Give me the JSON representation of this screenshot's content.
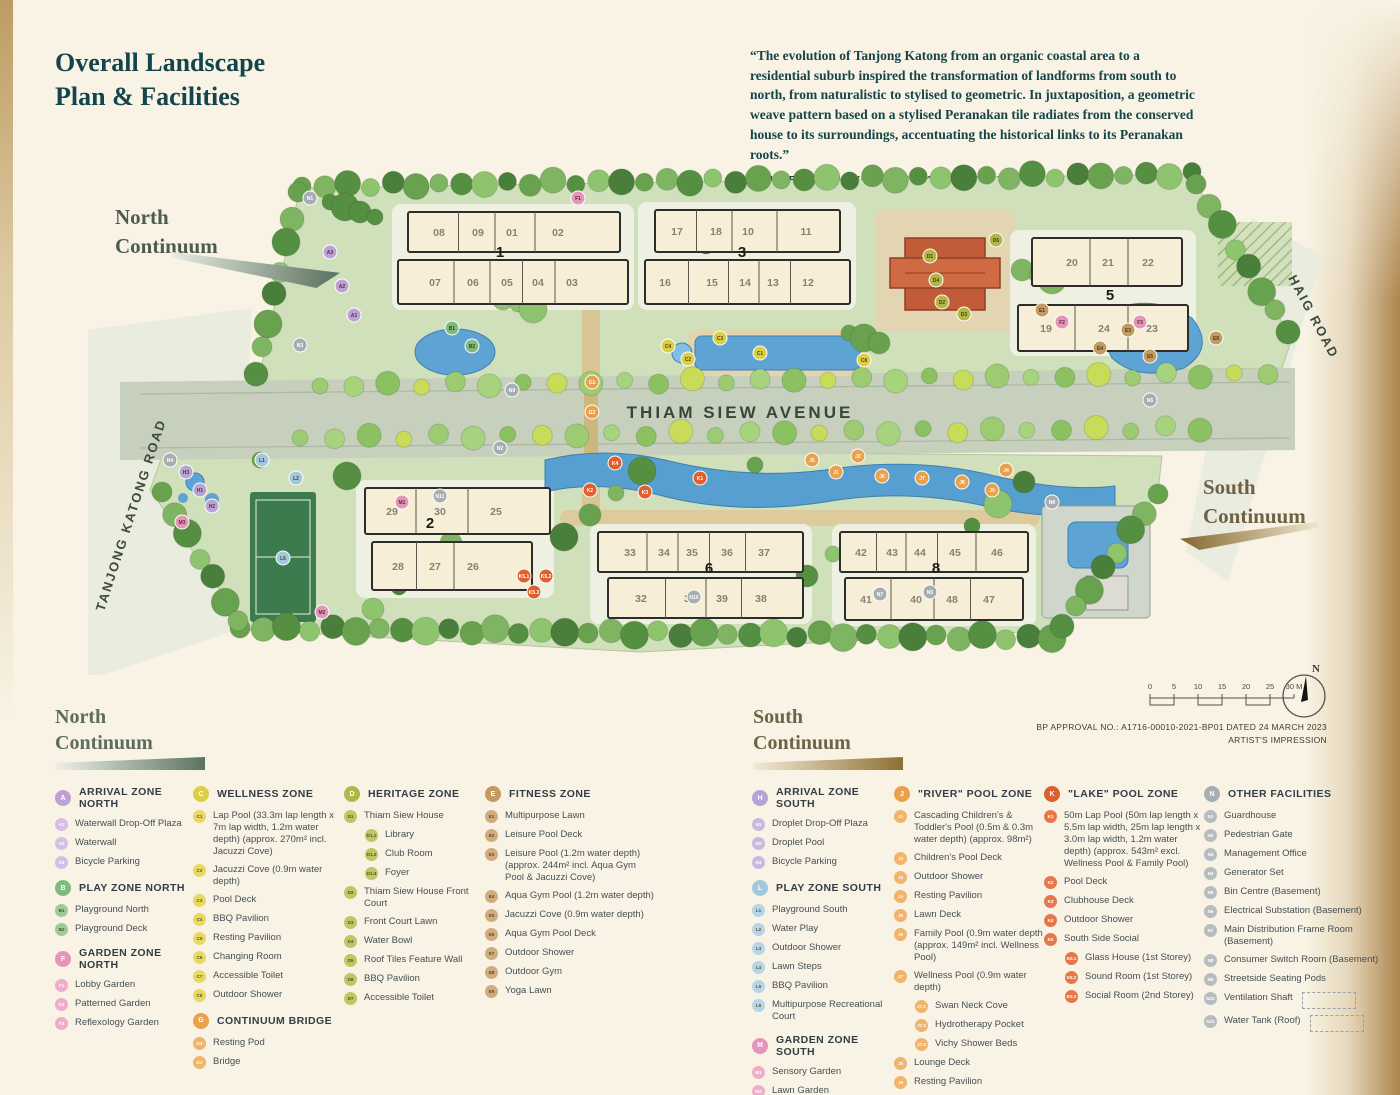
{
  "page": {
    "title": "Overall Landscape\nPlan & Facilities",
    "quote": "“The evolution of Tanjong Katong from an organic coastal area to a residential suburb inspired the transformation of landforms from south to north, from naturalistic to stylised to geometric. In juxtaposition, a geometric weave pattern based on a stylised Peranakan tile radiates from the conserved house to its surroundings, accentuating the historical links to its Peranakan roots.”",
    "attribution": "— HELEN SMITH–YEO, LANDSCAPE ARCHITECT"
  },
  "map": {
    "labels": {
      "north_continuum": "North\nContinuum",
      "south_continuum": "South\nContinuum",
      "avenue": "THIAM SIEW AVENUE",
      "road_left": "TANJONG KATONG ROAD",
      "road_right": "HAIG ROAD"
    },
    "blocks": [
      {
        "number": "1",
        "top": [
          "08",
          "09",
          "01",
          "02"
        ],
        "bottom": [
          "07",
          "06",
          "05",
          "04",
          "03"
        ]
      },
      {
        "number": "3",
        "top": [
          "17",
          "18",
          "10",
          "11"
        ],
        "bottom": [
          "16",
          "15",
          "14",
          "13",
          "12"
        ]
      },
      {
        "number": "5",
        "top": [
          "20",
          "21",
          "22"
        ],
        "bottom": [
          "19",
          "24",
          "23"
        ]
      },
      {
        "number": "2",
        "top": [
          "29",
          "30",
          "25"
        ],
        "bottom": [
          "28",
          "27",
          "26"
        ]
      },
      {
        "number": "6",
        "top": [
          "33",
          "34",
          "35",
          "36",
          "37"
        ],
        "bottom": [
          "32",
          "31",
          "39",
          "38"
        ]
      },
      {
        "number": "8",
        "top": [
          "42",
          "43",
          "44",
          "45",
          "46"
        ],
        "bottom": [
          "41",
          "40",
          "48",
          "47"
        ]
      }
    ],
    "badge_colors": {
      "A": "#bfa0d6",
      "B": "#7fbb7f",
      "C": "#ddcf45",
      "D": "#b2b647",
      "E": "#c49a63",
      "F": "#e794bb",
      "G": "#eaa14c",
      "H": "#b9a3d6",
      "J": "#eaa14c",
      "K": "#df5f2d",
      "L": "#a3c8de",
      "M": "#e794bb",
      "N": "#a7adb0"
    },
    "badges": [
      {
        "code": "N1",
        "x": 310,
        "y": 38
      },
      {
        "code": "A3",
        "x": 330,
        "y": 92
      },
      {
        "code": "A2",
        "x": 342,
        "y": 126
      },
      {
        "code": "A1",
        "x": 354,
        "y": 155
      },
      {
        "code": "N3",
        "x": 300,
        "y": 185
      },
      {
        "code": "F1",
        "x": 578,
        "y": 38
      },
      {
        "code": "B1",
        "x": 452,
        "y": 168
      },
      {
        "code": "B2",
        "x": 472,
        "y": 186
      },
      {
        "code": "C4",
        "x": 668,
        "y": 186
      },
      {
        "code": "C2",
        "x": 688,
        "y": 199
      },
      {
        "code": "C3",
        "x": 720,
        "y": 178
      },
      {
        "code": "C1",
        "x": 760,
        "y": 193
      },
      {
        "code": "C8",
        "x": 864,
        "y": 200
      },
      {
        "code": "G1",
        "x": 592,
        "y": 222
      },
      {
        "code": "G2",
        "x": 592,
        "y": 252
      },
      {
        "code": "N9",
        "x": 512,
        "y": 230
      },
      {
        "code": "D1",
        "x": 930,
        "y": 96
      },
      {
        "code": "D4",
        "x": 936,
        "y": 120
      },
      {
        "code": "D2",
        "x": 942,
        "y": 142
      },
      {
        "code": "D3",
        "x": 964,
        "y": 154
      },
      {
        "code": "D6",
        "x": 996,
        "y": 80
      },
      {
        "code": "E1",
        "x": 1042,
        "y": 150
      },
      {
        "code": "E3",
        "x": 1128,
        "y": 170
      },
      {
        "code": "E4",
        "x": 1100,
        "y": 188
      },
      {
        "code": "E5",
        "x": 1150,
        "y": 196
      },
      {
        "code": "E8",
        "x": 1216,
        "y": 178
      },
      {
        "code": "F2",
        "x": 1062,
        "y": 162
      },
      {
        "code": "F3",
        "x": 1140,
        "y": 162
      },
      {
        "code": "N2",
        "x": 500,
        "y": 288
      },
      {
        "code": "H3",
        "x": 186,
        "y": 312
      },
      {
        "code": "H1",
        "x": 200,
        "y": 330
      },
      {
        "code": "H2",
        "x": 212,
        "y": 346
      },
      {
        "code": "N4",
        "x": 170,
        "y": 300
      },
      {
        "code": "L1",
        "x": 262,
        "y": 300
      },
      {
        "code": "L2",
        "x": 296,
        "y": 318
      },
      {
        "code": "L6",
        "x": 283,
        "y": 398
      },
      {
        "code": "M3",
        "x": 182,
        "y": 362
      },
      {
        "code": "M1",
        "x": 402,
        "y": 342
      },
      {
        "code": "N11",
        "x": 440,
        "y": 336
      },
      {
        "code": "M2",
        "x": 322,
        "y": 452
      },
      {
        "code": "K5.1",
        "x": 524,
        "y": 416
      },
      {
        "code": "K5.2",
        "x": 546,
        "y": 416
      },
      {
        "code": "K5.3",
        "x": 534,
        "y": 432
      },
      {
        "code": "K4",
        "x": 615,
        "y": 303
      },
      {
        "code": "K2",
        "x": 590,
        "y": 330
      },
      {
        "code": "K1",
        "x": 700,
        "y": 318
      },
      {
        "code": "K3",
        "x": 645,
        "y": 332
      },
      {
        "code": "J5",
        "x": 812,
        "y": 300
      },
      {
        "code": "J1",
        "x": 836,
        "y": 312
      },
      {
        "code": "J2",
        "x": 858,
        "y": 296
      },
      {
        "code": "J6",
        "x": 882,
        "y": 316
      },
      {
        "code": "J7",
        "x": 922,
        "y": 318
      },
      {
        "code": "J8",
        "x": 962,
        "y": 322
      },
      {
        "code": "J9",
        "x": 992,
        "y": 330
      },
      {
        "code": "J4",
        "x": 1006,
        "y": 310
      },
      {
        "code": "N5",
        "x": 930,
        "y": 432
      },
      {
        "code": "N10",
        "x": 694,
        "y": 437
      },
      {
        "code": "N8",
        "x": 1052,
        "y": 342
      },
      {
        "code": "N6",
        "x": 1150,
        "y": 240
      },
      {
        "code": "N7",
        "x": 880,
        "y": 434
      }
    ]
  },
  "legend": {
    "north_header": "North\nContinuum",
    "south_header": "South\nContinuum",
    "groups": [
      {
        "id": "A",
        "letter": "A",
        "title": "ARRIVAL ZONE NORTH",
        "color": "#bfa0d6",
        "item_color": "#d6bfe6",
        "items": [
          {
            "code": "A1",
            "label": "Waterwall Drop-Off Plaza"
          },
          {
            "code": "A2",
            "label": "Waterwall"
          },
          {
            "code": "A3",
            "label": "Bicycle Parking"
          }
        ]
      },
      {
        "id": "B",
        "letter": "B",
        "title": "PLAY ZONE NORTH",
        "color": "#7fbb7f",
        "item_color": "#9bcc97",
        "items": [
          {
            "code": "B1",
            "label": "Playground North"
          },
          {
            "code": "B2",
            "label": "Playground Deck"
          }
        ]
      },
      {
        "id": "F",
        "letter": "F",
        "title": "GARDEN ZONE NORTH",
        "color": "#e794bb",
        "item_color": "#efadc9",
        "items": [
          {
            "code": "F1",
            "label": "Lobby Garden"
          },
          {
            "code": "F2",
            "label": "Patterned Garden"
          },
          {
            "code": "F3",
            "label": "Reflexology Garden"
          }
        ]
      },
      {
        "id": "C",
        "letter": "C",
        "title": "WELLNESS ZONE",
        "color": "#ddcf45",
        "item_color": "#e6da63",
        "items": [
          {
            "code": "C1",
            "label": "Lap Pool (33.3m lap length x 7m lap width, 1.2m water depth) (approx. 270m² incl. Jacuzzi Cove)"
          },
          {
            "code": "C2",
            "label": "Jacuzzi Cove (0.9m water depth)"
          },
          {
            "code": "C3",
            "label": "Pool Deck"
          },
          {
            "code": "C4",
            "label": "BBQ Pavilion"
          },
          {
            "code": "C5",
            "label": "Resting Pavilion"
          },
          {
            "code": "C6",
            "label": "Changing Room"
          },
          {
            "code": "C7",
            "label": "Accessible Toilet"
          },
          {
            "code": "C8",
            "label": "Outdoor Shower"
          }
        ]
      },
      {
        "id": "G",
        "letter": "G",
        "title": "CONTINUUM BRIDGE",
        "color": "#eaa14c",
        "item_color": "#f0b46c",
        "items": [
          {
            "code": "G1",
            "label": "Resting Pod"
          },
          {
            "code": "G2",
            "label": "Bridge"
          }
        ]
      },
      {
        "id": "D",
        "letter": "D",
        "title": "HERITAGE ZONE",
        "color": "#b2b647",
        "item_color": "#c2c563",
        "items": [
          {
            "code": "D1",
            "label": "Thiam Siew House"
          },
          {
            "code": "D1.1",
            "label": "Library",
            "sub": true
          },
          {
            "code": "D1.2",
            "label": "Club Room",
            "sub": true
          },
          {
            "code": "D1.3",
            "label": "Foyer",
            "sub": true
          },
          {
            "code": "D2",
            "label": "Thiam Siew House Front Court"
          },
          {
            "code": "D3",
            "label": "Front Court Lawn"
          },
          {
            "code": "D4",
            "label": "Water Bowl"
          },
          {
            "code": "D5",
            "label": "Roof Tiles Feature Wall"
          },
          {
            "code": "D6",
            "label": "BBQ Pavilion"
          },
          {
            "code": "D7",
            "label": "Accessible Toilet"
          }
        ]
      },
      {
        "id": "E",
        "letter": "E",
        "title": "FITNESS ZONE",
        "color": "#c49a63",
        "item_color": "#d0ab7c",
        "items": [
          {
            "code": "E1",
            "label": "Multipurpose Lawn"
          },
          {
            "code": "E2",
            "label": "Leisure Pool Deck"
          },
          {
            "code": "E3",
            "label": "Leisure Pool (1.2m water depth) (approx. 244m² incl. Aqua Gym Pool & Jacuzzi Cove)"
          },
          {
            "code": "E4",
            "label": "Aqua Gym Pool (1.2m water depth)"
          },
          {
            "code": "E5",
            "label": "Jacuzzi Cove (0.9m water depth)"
          },
          {
            "code": "E6",
            "label": "Aqua Gym Pool Deck"
          },
          {
            "code": "E7",
            "label": "Outdoor Shower"
          },
          {
            "code": "E8",
            "label": "Outdoor Gym"
          },
          {
            "code": "E9",
            "label": "Yoga Lawn"
          }
        ]
      },
      {
        "id": "H",
        "letter": "H",
        "title": "ARRIVAL ZONE SOUTH",
        "color": "#b9a3d6",
        "item_color": "#cab8e0",
        "items": [
          {
            "code": "H1",
            "label": "Droplet Drop-Off Plaza"
          },
          {
            "code": "H2",
            "label": "Droplet Pool"
          },
          {
            "code": "H3",
            "label": "Bicycle Parking"
          }
        ]
      },
      {
        "id": "L",
        "letter": "L",
        "title": "PLAY ZONE SOUTH",
        "color": "#a3c8de",
        "item_color": "#b7d5e6",
        "items": [
          {
            "code": "L1",
            "label": "Playground South"
          },
          {
            "code": "L2",
            "label": "Water Play"
          },
          {
            "code": "L3",
            "label": "Outdoor Shower"
          },
          {
            "code": "L4",
            "label": "Lawn Steps"
          },
          {
            "code": "L5",
            "label": "BBQ Pavilion"
          },
          {
            "code": "L6",
            "label": "Multipurpose Recreational Court"
          }
        ]
      },
      {
        "id": "M",
        "letter": "M",
        "title": "GARDEN ZONE SOUTH",
        "color": "#e794bb",
        "item_color": "#efadc9",
        "items": [
          {
            "code": "M1",
            "label": "Sensory Garden"
          },
          {
            "code": "M2",
            "label": "Lawn Garden"
          },
          {
            "code": "M3",
            "label": "Reflexology Garden"
          }
        ]
      },
      {
        "id": "J",
        "letter": "J",
        "title": "\"RIVER\" POOL ZONE",
        "color": "#eaa14c",
        "item_color": "#f0b46c",
        "items": [
          {
            "code": "J1",
            "label": "Cascading Children's & Toddler's Pool (0.5m & 0.3m water depth) (approx. 98m²)"
          },
          {
            "code": "J2",
            "label": "Children's Pool Deck"
          },
          {
            "code": "J3",
            "label": "Outdoor Shower"
          },
          {
            "code": "J4",
            "label": "Resting Pavilion"
          },
          {
            "code": "J5",
            "label": "Lawn Deck"
          },
          {
            "code": "J6",
            "label": "Family Pool (0.9m water depth (approx. 149m² incl. Wellness Pool)"
          },
          {
            "code": "J7",
            "label": "Wellness Pool (0.9m water depth)"
          },
          {
            "code": "J7.1",
            "label": "Swan Neck Cove",
            "sub": true
          },
          {
            "code": "J7.2",
            "label": "Hydrotherapy Pocket",
            "sub": true
          },
          {
            "code": "J7.3",
            "label": "Vichy Shower Beds",
            "sub": true
          },
          {
            "code": "J8",
            "label": "Lounge Deck"
          },
          {
            "code": "J9",
            "label": "Resting Pavilion"
          },
          {
            "code": "J10",
            "label": "Changing Room"
          },
          {
            "code": "J11",
            "label": "Accessible Toilet"
          }
        ]
      },
      {
        "id": "K",
        "letter": "K",
        "title": "\"LAKE\" POOL ZONE",
        "color": "#df5f2d",
        "item_color": "#e67748",
        "items": [
          {
            "code": "K1",
            "label": "50m Lap Pool (50m lap length x 5.5m lap width, 25m lap length x 3.0m lap width, 1.2m water depth) (approx. 543m² excl. Wellness Pool & Family Pool)"
          },
          {
            "code": "K2",
            "label": "Pool Deck"
          },
          {
            "code": "K3",
            "label": "Clubhouse Deck"
          },
          {
            "code": "K4",
            "label": "Outdoor Shower"
          },
          {
            "code": "K5",
            "label": "South Side Social"
          },
          {
            "code": "K5.1",
            "label": "Glass House (1st Storey)",
            "sub": true
          },
          {
            "code": "K5.2",
            "label": "Sound Room (1st Storey)",
            "sub": true
          },
          {
            "code": "K5.3",
            "label": "Social Room (2nd Storey)",
            "sub": true
          }
        ]
      },
      {
        "id": "N",
        "letter": "N",
        "title": "OTHER FACILITIES",
        "color": "#a7adb0",
        "item_color": "#b7bcbf",
        "items": [
          {
            "code": "N1",
            "label": "Guardhouse"
          },
          {
            "code": "N2",
            "label": "Pedestrian Gate"
          },
          {
            "code": "N3",
            "label": "Management Office"
          },
          {
            "code": "N4",
            "label": "Generator Set"
          },
          {
            "code": "N5",
            "label": "Bin Centre (Basement)"
          },
          {
            "code": "N6",
            "label": "Electrical Substation (Basement)"
          },
          {
            "code": "N7",
            "label": "Main Distribution Frame Room (Basement)"
          },
          {
            "code": "N8",
            "label": "Consumer Switch Room (Basement)"
          },
          {
            "code": "N9",
            "label": "Streetside Seating Pods"
          },
          {
            "code": "N10",
            "label": "Ventilation Shaft",
            "dashed_box": true
          },
          {
            "code": "N11",
            "label": "Water Tank (Roof)",
            "dashed_box": true
          }
        ]
      }
    ]
  },
  "annotations": {
    "scale_ticks": [
      "0",
      "5",
      "10",
      "15",
      "20",
      "25",
      "30 M"
    ],
    "bp_approval": "BP APPROVAL NO.: A1716-00010-2021-BP01 DATED 24 MARCH 2023",
    "impression": "ARTIST'S IMPRESSION",
    "compass_label": "N"
  }
}
